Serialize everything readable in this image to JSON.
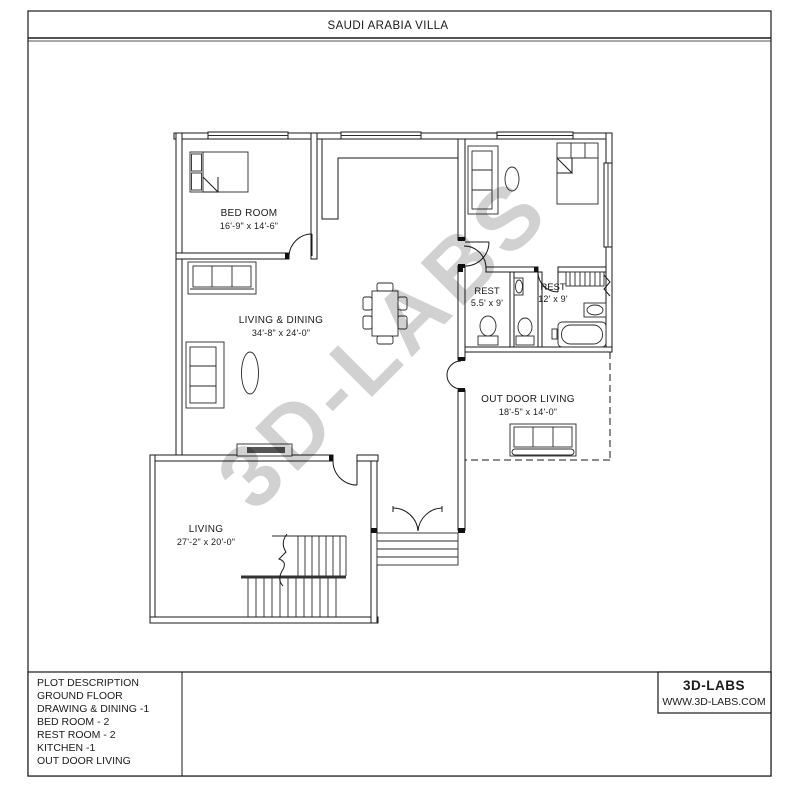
{
  "title": "SAUDI ARABIA VILLA",
  "watermark": "3D-LABS",
  "colors": {
    "ink": "#1a1a1a",
    "watermark": "#c4c4c4",
    "tv_fill": "#555555"
  },
  "rooms": {
    "bedroom": {
      "label": "BED ROOM",
      "dims": "16'-9\" x 14'-6\""
    },
    "living_dining": {
      "label": "LIVING & DINING",
      "dims": "34'-8\" x 24'-0\""
    },
    "rest_small": {
      "label": "REST",
      "dims": "5.5' x 9'"
    },
    "rest_large": {
      "label": "REST",
      "dims": "12' x 9'"
    },
    "outdoor": {
      "label": "OUT DOOR LIVING",
      "dims": "18'-5\" x 14'-0\""
    },
    "living": {
      "label": "LIVING",
      "dims": "27'-2\" x 20'-0\""
    }
  },
  "plot_description": {
    "lines": [
      "PLOT DESCRIPTION",
      "GROUND FLOOR",
      "DRAWING  & DINING -1",
      "BED ROOM - 2",
      "REST ROOM - 2",
      "KITCHEN -1",
      "OUT DOOR LIVING"
    ]
  },
  "brand": {
    "name": "3D-LABS",
    "website": "WWW.3D-LABS.COM"
  }
}
